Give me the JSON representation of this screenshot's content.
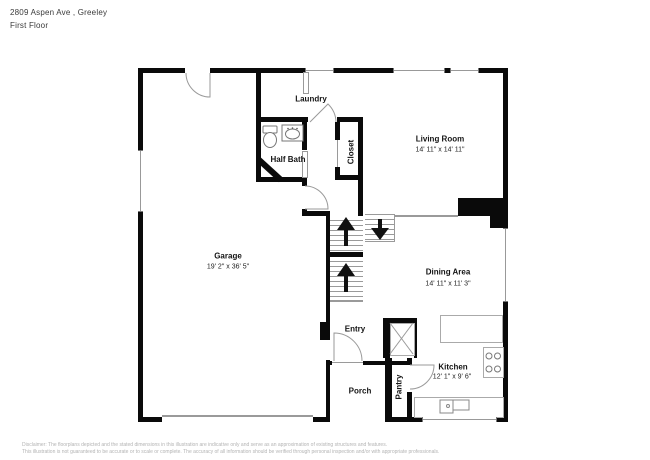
{
  "header": {
    "address": "2809 Aspen Ave , Greeley",
    "floor": "First Floor"
  },
  "rooms": {
    "laundry": {
      "name": "Laundry"
    },
    "living": {
      "name": "Living Room",
      "dims": "14' 11\" x 14' 11\""
    },
    "half_bath": {
      "name": "Half Bath"
    },
    "closet": {
      "name": "Closet"
    },
    "garage": {
      "name": "Garage",
      "dims": "19' 2\" x 36' 5\""
    },
    "dining": {
      "name": "Dining Area",
      "dims": "14' 11\" x 11' 3\""
    },
    "entry": {
      "name": "Entry"
    },
    "kitchen": {
      "name": "Kitchen",
      "dims": "12' 1\" x 9' 6\""
    },
    "porch": {
      "name": "Porch"
    },
    "pantry": {
      "name": "Pantry"
    }
  },
  "footer": {
    "line1": "Disclaimer: The floorplans depicted and the stated dimensions in this illustration are indicative only and serve as an approximation of existing structures and features.",
    "line2": "This illustration is not guaranteed to be accurate or to scale or complete. The accuracy of all information should be verified through personal inspection and/or with appropriate professionals."
  },
  "colors": {
    "wall": "#0a0a0a",
    "thin_line": "#9a9a9a",
    "label_text": "#141414",
    "footer_text": "#b3b3b3"
  }
}
